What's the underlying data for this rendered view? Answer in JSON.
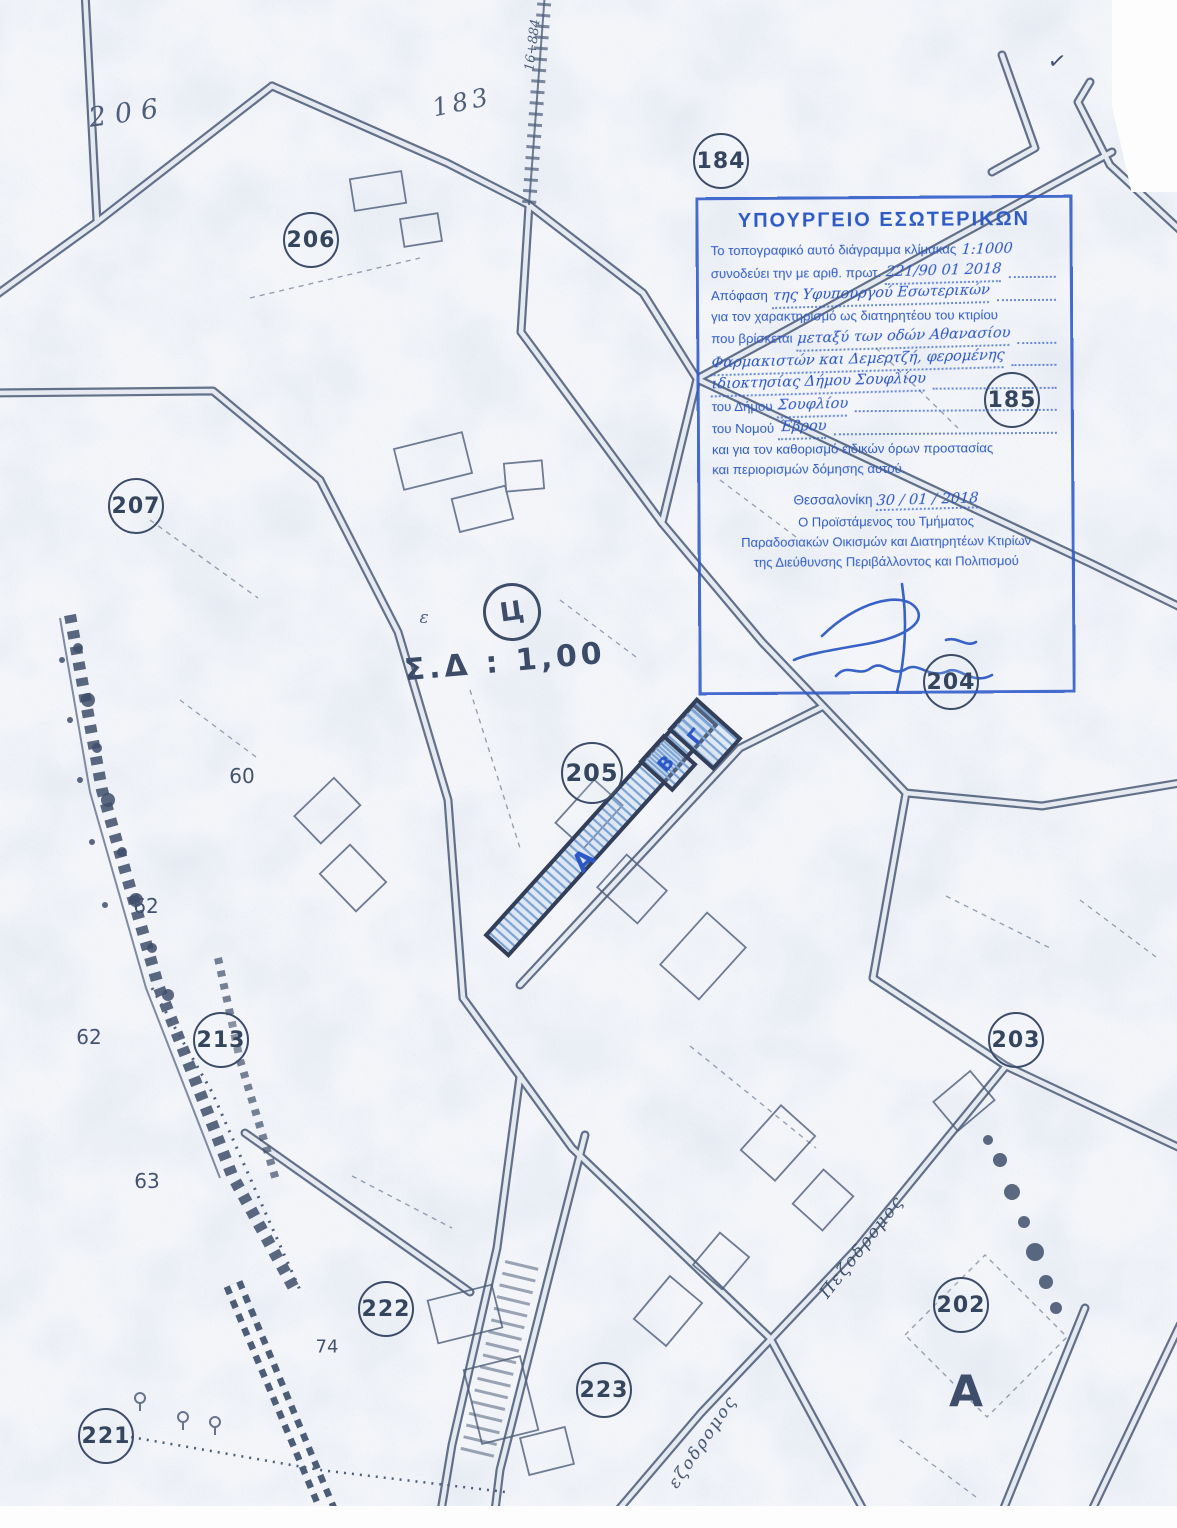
{
  "colors": {
    "stamp_blue": "#2e5ac6",
    "map_ink": "#4c5c78",
    "hatch_blue": "#7aa2d2",
    "paper": "#f3f5f9"
  },
  "stamp": {
    "title": "ΥΠΟΥΡΓΕΙΟ ΕΣΩΤΕΡΙΚΩΝ",
    "l1_pre": "Το τοπογραφικό αυτό διάγραμμα κλίμακας",
    "l1_hand": "1:1000",
    "l2_pre": "συνοδεύει την με αριθ. πρωτ.",
    "l2_hand": "221/90 01 2018",
    "l3_pre": "Απόφαση",
    "l3_hand": "της Υφυπουργού Εσωτερικών",
    "l4": "για τον χαρακτηρισμό ως διατηρητέου του κτιρίου",
    "l5_pre": "που βρίσκεται",
    "l5_hand": "μεταξύ των οδών Αθανασίου",
    "l6_hand": "Φαρμακιστών και Δεμερτζή, φερομένης",
    "l7_hand": "ιδιοκτησίας Δήμου Σουφλίου",
    "l8_pre": "του Δήμου",
    "l8_hand": "Σουφλίου",
    "l9_pre": "του Νομού",
    "l9_hand": "Έβρου",
    "l10": "και για τον καθορισμό ειδικών όρων προστασίας",
    "l11": "και περιορισμών δόμησης αυτού.",
    "date_pre": "Θεσσαλονίκη",
    "date_hand": "30 / 01 / 2018",
    "sig1": "Ο Προϊστάμενος του Τμήματος",
    "sig2": "Παραδοσιακών Οικισμών και Διατηρητέων Κτιρίων",
    "sig3": "της Διεύθυνσης Περιβάλλοντος και Πολιτισμού"
  },
  "map": {
    "scale_label": "Σ.Δ : 1,00",
    "circle_symbol": "Ц",
    "epsilon_mark": "ε",
    "check_mark": "✓",
    "circled": {
      "c184": "184",
      "c185": "185",
      "c202": "202",
      "c203": "203",
      "c204": "204",
      "c205": "205",
      "c206": "206",
      "c207": "207",
      "c213": "213",
      "c221": "221",
      "c222": "222",
      "c223": "223"
    },
    "handwritten": {
      "hw206": "206",
      "hw183": "183",
      "chainage": "16+884"
    },
    "parcel_numbers": {
      "n60": "60",
      "n62a": "62",
      "n62b": "62",
      "n63": "63",
      "n74": "74"
    },
    "zone_letter": "Α",
    "street_name_1": "Πεζοδρομος",
    "street_name_2": "εζοδρομος",
    "parcels": {
      "a": "Α",
      "b": "Β",
      "g": "Γ"
    }
  }
}
